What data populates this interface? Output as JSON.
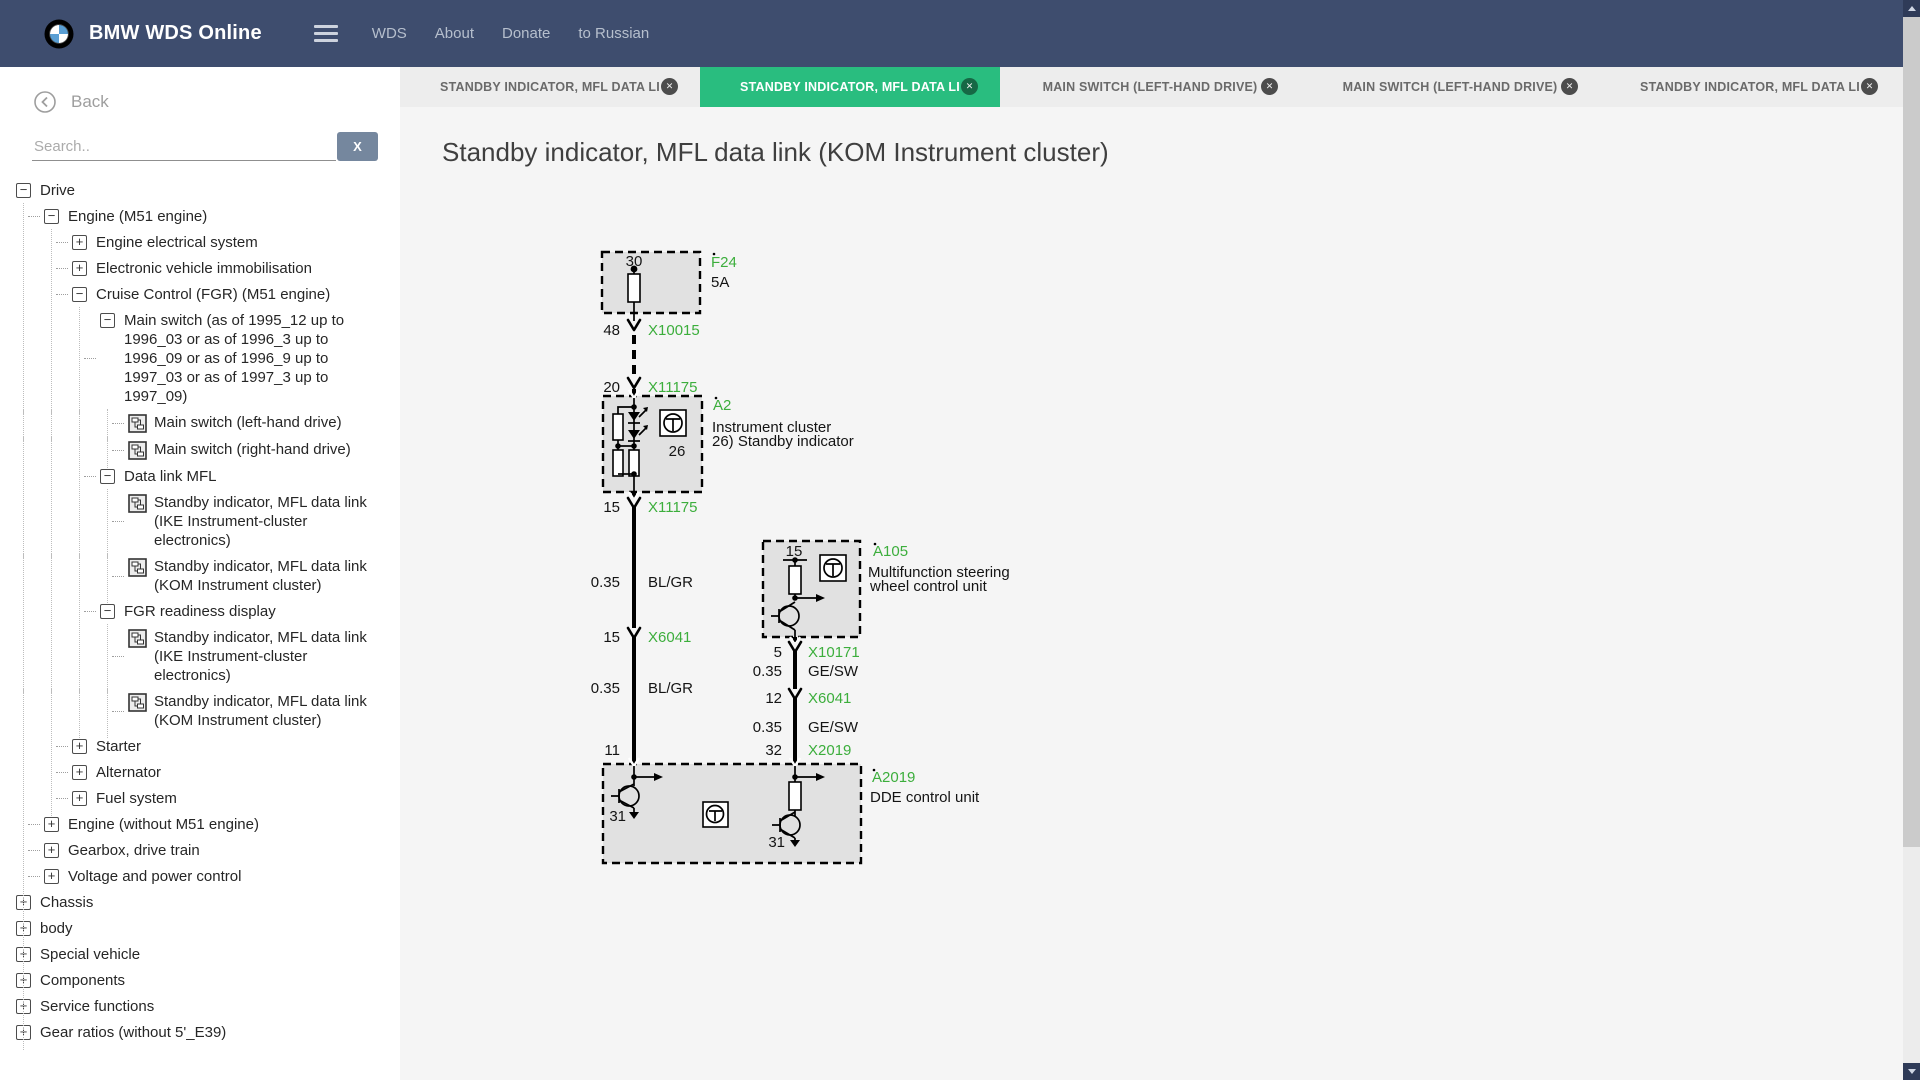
{
  "navbar": {
    "brand": "BMW WDS Online",
    "links": [
      {
        "label": "WDS"
      },
      {
        "label": "About"
      },
      {
        "label": "Donate"
      },
      {
        "label": "to Russian"
      }
    ]
  },
  "sidebar": {
    "back_label": "Back",
    "search_placeholder": "Search..",
    "search_clear_label": "X",
    "glyphs": {
      "minus": "−",
      "plus": "+"
    },
    "tree": [
      {
        "depth": 0,
        "toggle": "minus",
        "label": "Drive"
      },
      {
        "depth": 1,
        "toggle": "minus",
        "label": "Engine (M51 engine)"
      },
      {
        "depth": 2,
        "toggle": "plus",
        "label": "Engine electrical system"
      },
      {
        "depth": 2,
        "toggle": "plus",
        "label": "Electronic vehicle immobilisation"
      },
      {
        "depth": 2,
        "toggle": "minus",
        "label": "Cruise Control (FGR) (M51 engine)"
      },
      {
        "depth": 3,
        "toggle": "minus",
        "label": "Main switch (as of 1995_12 up to 1996_03 or as of 1996_3 up to 1996_09 or as of 1996_9 up to 1997_03 or as of 1997_3 up to 1997_09)"
      },
      {
        "depth": 4,
        "icon": "diagram",
        "label": "Main switch (left-hand drive)"
      },
      {
        "depth": 4,
        "icon": "diagram",
        "label": "Main switch (right-hand drive)"
      },
      {
        "depth": 3,
        "toggle": "minus",
        "label": "Data link MFL"
      },
      {
        "depth": 4,
        "icon": "diagram",
        "label": "Standby indicator, MFL data link (IKE Instrument-cluster electronics)"
      },
      {
        "depth": 4,
        "icon": "diagram",
        "label": "Standby indicator, MFL data link (KOM Instrument cluster)"
      },
      {
        "depth": 3,
        "toggle": "minus",
        "label": "FGR readiness display"
      },
      {
        "depth": 4,
        "icon": "diagram",
        "label": "Standby indicator, MFL data link (IKE Instrument-cluster electronics)"
      },
      {
        "depth": 4,
        "icon": "diagram",
        "label": "Standby indicator, MFL data link (KOM Instrument cluster)"
      },
      {
        "depth": 2,
        "toggle": "plus",
        "label": "Starter"
      },
      {
        "depth": 2,
        "toggle": "plus",
        "label": "Alternator"
      },
      {
        "depth": 2,
        "toggle": "plus",
        "label": "Fuel system"
      },
      {
        "depth": 1,
        "toggle": "plus",
        "label": "Engine (without M51 engine)"
      },
      {
        "depth": 1,
        "toggle": "plus",
        "label": "Gearbox, drive train"
      },
      {
        "depth": 1,
        "toggle": "plus",
        "label": "Voltage and power control"
      },
      {
        "depth": 0,
        "toggle": "plus",
        "label": "Chassis"
      },
      {
        "depth": 0,
        "toggle": "plus",
        "label": "body"
      },
      {
        "depth": 0,
        "toggle": "plus",
        "label": "Special vehicle"
      },
      {
        "depth": 0,
        "toggle": "plus",
        "label": "Components"
      },
      {
        "depth": 0,
        "toggle": "plus",
        "label": "Service functions"
      },
      {
        "depth": 0,
        "toggle": "plus",
        "label": "Gear ratios (without 5'_E39)"
      }
    ]
  },
  "tabs": {
    "close_glyph": "✕",
    "items": [
      {
        "label": "STANDBY INDICATOR, MFL DATA LI",
        "active": false
      },
      {
        "label": "STANDBY INDICATOR, MFL DATA LI",
        "active": true
      },
      {
        "label": "MAIN SWITCH (LEFT-HAND DRIVE)",
        "active": false
      },
      {
        "label": "MAIN SWITCH (LEFT-HAND DRIVE)",
        "active": false
      },
      {
        "label": "STANDBY INDICATOR, MFL DATA LI",
        "active": false
      }
    ]
  },
  "main": {
    "title": "Standby indicator, MFL data link (KOM Instrument cluster)"
  },
  "diagram": {
    "f24": {
      "terminal": "30",
      "id": "F24",
      "rating": "5A"
    },
    "x10015": {
      "pin": "48",
      "name": "X10015"
    },
    "x11175_top": {
      "pin": "20",
      "name": "X11175"
    },
    "a2": {
      "id": "A2",
      "name1": "Instrument cluster",
      "name2": "26) Standby indicator",
      "pin": "26"
    },
    "x11175_bot": {
      "pin": "15",
      "name": "X11175"
    },
    "wire1a": {
      "gauge": "0.35",
      "code": "BL/GR"
    },
    "x6041_l": {
      "pin": "15",
      "name": "X6041"
    },
    "wire1b": {
      "gauge": "0.35",
      "code": "BL/GR"
    },
    "dde_pin_left": "11",
    "a105": {
      "id": "A105",
      "pin": "15",
      "name1": "Multifunction steering",
      "name2": " wheel control unit"
    },
    "x10171": {
      "pin": "5",
      "name": "X10171"
    },
    "wire2a": {
      "gauge": "0.35",
      "code": "GE/SW"
    },
    "x6041_r": {
      "pin": "12",
      "name": "X6041"
    },
    "wire2b": {
      "gauge": "0.35",
      "code": "GE/SW"
    },
    "x2019": {
      "pin": "32",
      "name": "X2019"
    },
    "a2019": {
      "id": "A2019",
      "name": "DDE control unit",
      "gnd_left": "31",
      "gnd_right": "31"
    }
  },
  "colors": {
    "navbar_bg": "#3e4d6e",
    "active_tab_green": "#29bd7f",
    "diagram_green": "#3cae3c",
    "bmw_blue": "#5a9fd4"
  }
}
